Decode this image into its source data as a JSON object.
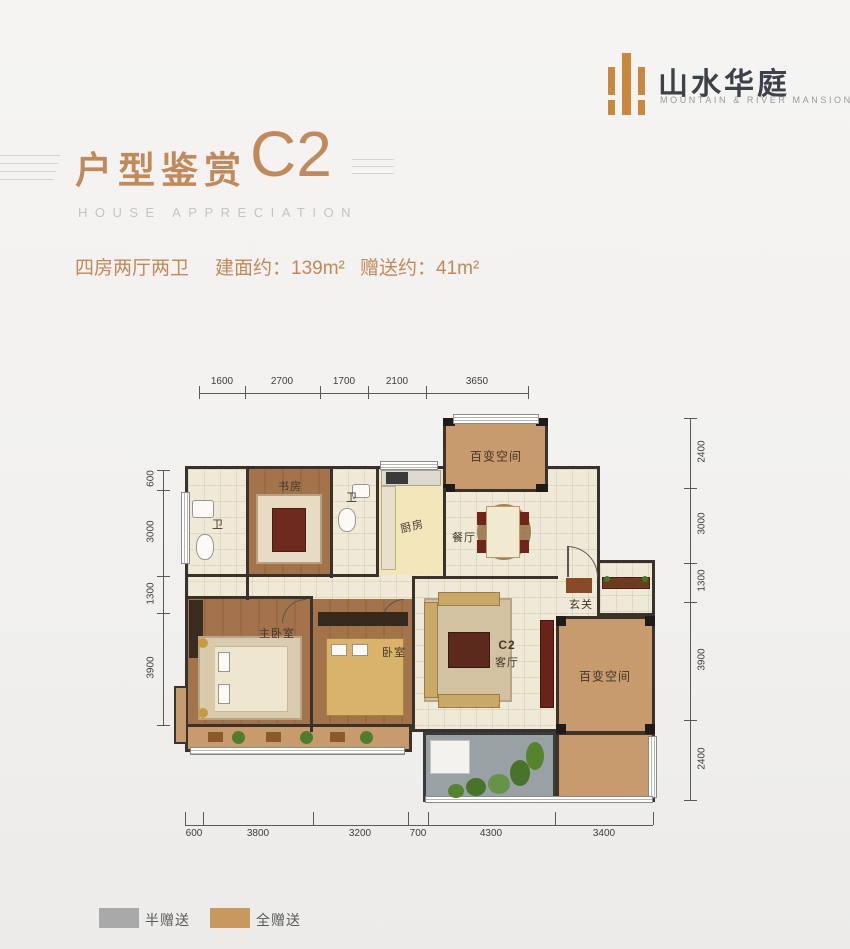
{
  "logo": {
    "icon": "bars-logo",
    "name_cn": "山水华庭",
    "name_en": "MOUNTAIN & RIVER MANSION"
  },
  "header": {
    "title": "户型鉴赏",
    "unit_code": "C2",
    "subtitle": "HOUSE APPRECIATION"
  },
  "summary": {
    "layout_type": "四房两厅两卫",
    "built_area": "建面约：139m²",
    "gift_area": "赠送约：41m²"
  },
  "plan": {
    "rooms": {
      "bath1": "卫",
      "study": "书房",
      "bath2": "卫",
      "kitchen": "厨房",
      "flex_top": "百变空间",
      "dining": "餐厅",
      "foyer": "玄关",
      "master": "主卧室",
      "bedroom": "卧室",
      "living_code": "C2",
      "living": "客厅",
      "flex_right": "百变空间"
    },
    "dimensions": {
      "top": [
        "1600",
        "2700",
        "1700",
        "2100",
        "3650"
      ],
      "left": [
        "600",
        "3000",
        "1300",
        "3900"
      ],
      "right": [
        "2400",
        "3000",
        "1300",
        "3900",
        "2400"
      ],
      "bottom": [
        "600",
        "3800",
        "3200",
        "700",
        "4300",
        "3400"
      ]
    }
  },
  "legend": {
    "half": {
      "label": "半赠送",
      "color": "#a9a9a9"
    },
    "full": {
      "label": "全赠送",
      "color": "#c9985e"
    }
  },
  "colors": {
    "accent": "#c08a5c",
    "wall": "#38322b",
    "gift_full": "#c79b6d",
    "gift_half": "#9aa1a4"
  }
}
